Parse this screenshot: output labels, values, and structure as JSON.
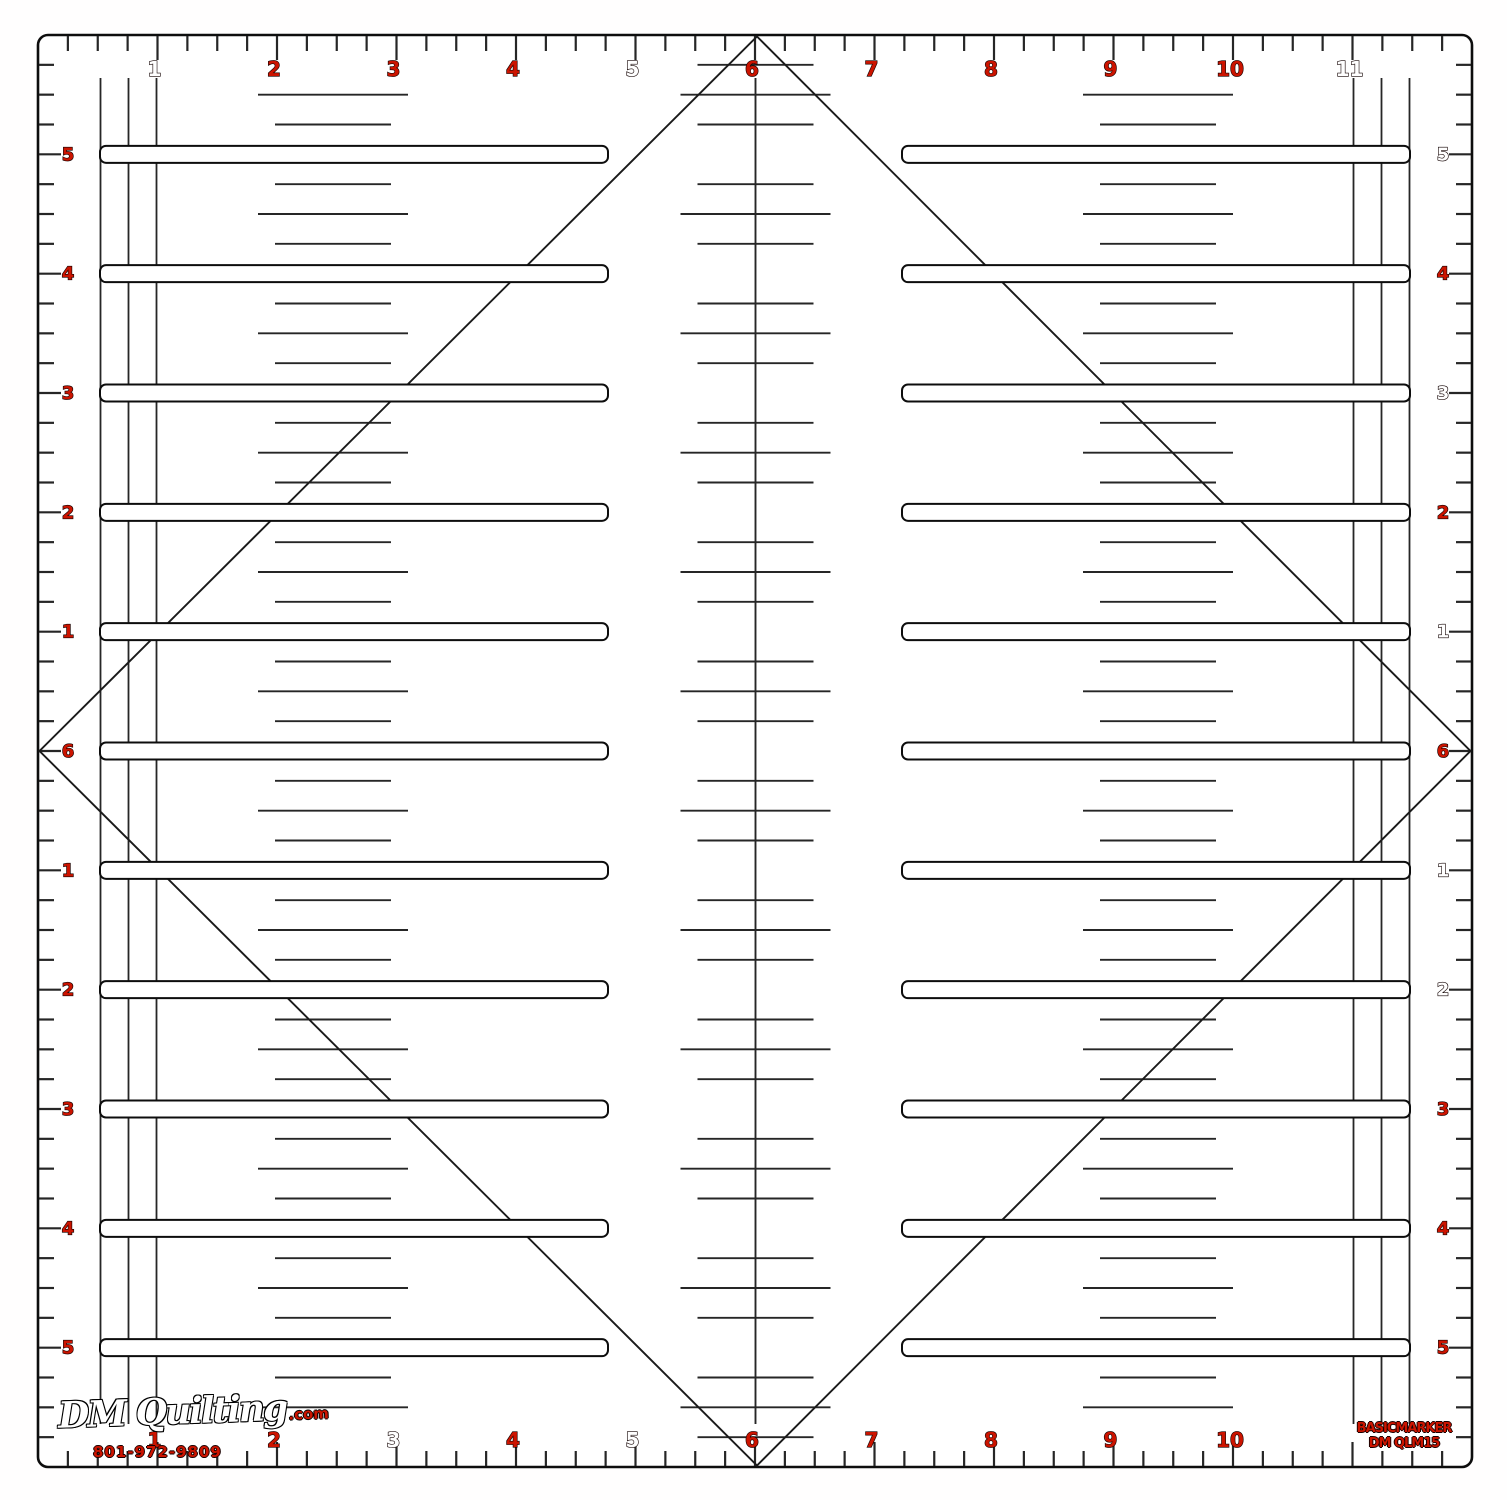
{
  "ruler": {
    "top_numbers": [
      {
        "label": "1",
        "style": "hollow"
      },
      {
        "label": "2",
        "style": "red"
      },
      {
        "label": "3",
        "style": "red"
      },
      {
        "label": "4",
        "style": "red"
      },
      {
        "label": "5",
        "style": "hollow"
      },
      {
        "label": "6",
        "style": "red"
      },
      {
        "label": "7",
        "style": "red"
      },
      {
        "label": "8",
        "style": "red"
      },
      {
        "label": "9",
        "style": "red"
      },
      {
        "label": "10",
        "style": "red"
      },
      {
        "label": "11",
        "style": "hollow"
      }
    ],
    "bottom_numbers": [
      {
        "label": "1",
        "style": "red"
      },
      {
        "label": "2",
        "style": "red"
      },
      {
        "label": "3",
        "style": "hollow"
      },
      {
        "label": "4",
        "style": "red"
      },
      {
        "label": "5",
        "style": "hollow"
      },
      {
        "label": "6",
        "style": "red"
      },
      {
        "label": "7",
        "style": "red"
      },
      {
        "label": "8",
        "style": "red"
      },
      {
        "label": "9",
        "style": "red"
      },
      {
        "label": "10",
        "style": "red"
      }
    ],
    "left_numbers": [
      {
        "label": "5",
        "style": "red"
      },
      {
        "label": "4",
        "style": "red"
      },
      {
        "label": "3",
        "style": "red"
      },
      {
        "label": "2",
        "style": "red"
      },
      {
        "label": "1",
        "style": "red"
      },
      {
        "label": "6",
        "style": "red"
      },
      {
        "label": "1",
        "style": "red"
      },
      {
        "label": "2",
        "style": "red"
      },
      {
        "label": "3",
        "style": "red"
      },
      {
        "label": "4",
        "style": "red"
      },
      {
        "label": "5",
        "style": "red"
      }
    ],
    "right_numbers": [
      {
        "label": "5",
        "style": "hollow"
      },
      {
        "label": "4",
        "style": "red"
      },
      {
        "label": "3",
        "style": "hollow"
      },
      {
        "label": "2",
        "style": "red"
      },
      {
        "label": "1",
        "style": "hollow"
      },
      {
        "label": "6",
        "style": "red"
      },
      {
        "label": "1",
        "style": "hollow"
      },
      {
        "label": "2",
        "style": "hollow"
      },
      {
        "label": "3",
        "style": "red"
      },
      {
        "label": "4",
        "style": "red"
      },
      {
        "label": "5",
        "style": "red"
      }
    ]
  },
  "branding": {
    "logo_script": "DM Quilting",
    "logo_suffix": ".com",
    "phone": "801-972-9809"
  },
  "product": {
    "line1": "BASICMARKER",
    "line2": "DM QLM15"
  },
  "colors": {
    "number_red": "#cc1400",
    "ink": "#0d0d0d",
    "line": "#262626",
    "plate": "#ffffff"
  }
}
